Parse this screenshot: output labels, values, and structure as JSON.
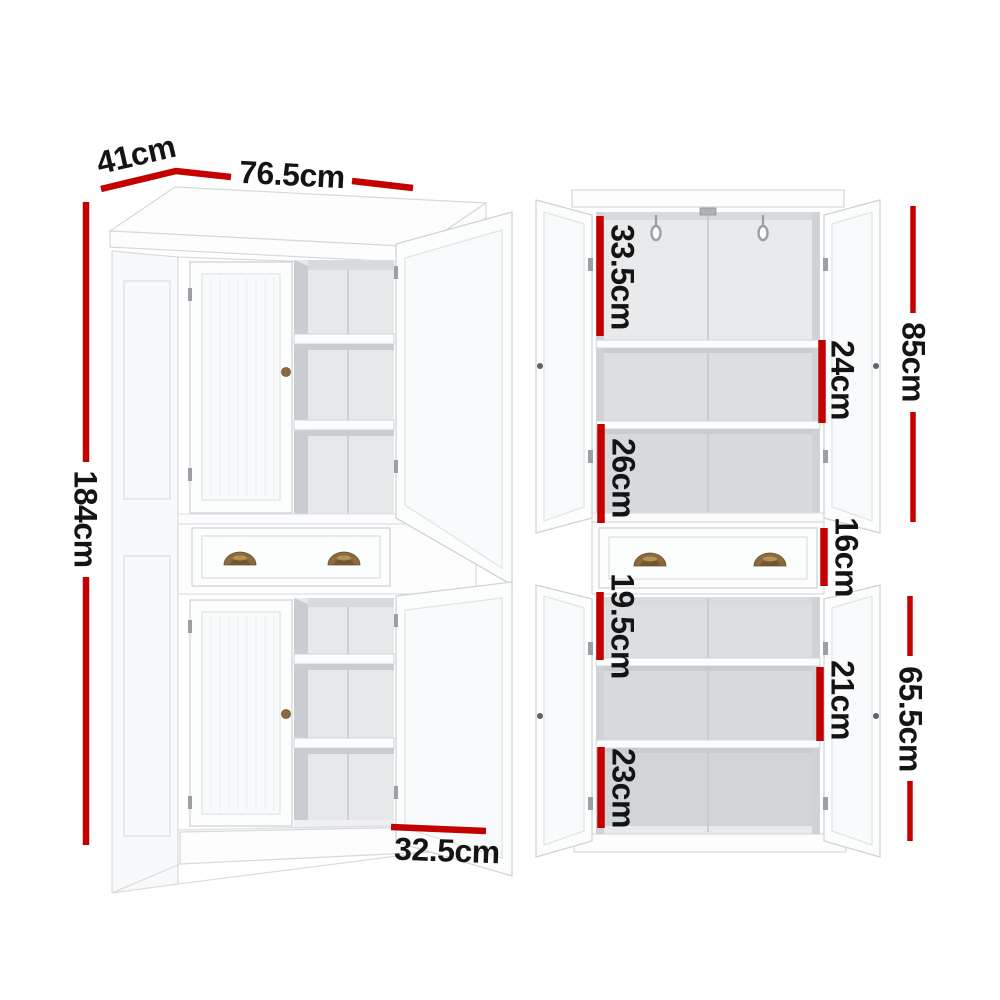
{
  "page": {
    "background": "#ffffff"
  },
  "colors": {
    "dimension_red": "#c50000",
    "label_text": "#141414",
    "handle_bronze": "#8a6a3e"
  },
  "product": {
    "name": "white-pantry-cabinet-dimension-diagram",
    "views": [
      {
        "id": "angled-view",
        "dimensions": [
          {
            "id": "depth",
            "label": "41cm"
          },
          {
            "id": "width",
            "label": "76.5cm"
          },
          {
            "id": "height",
            "label": "184cm"
          },
          {
            "id": "lower-door-width",
            "label": "32.5cm"
          }
        ]
      },
      {
        "id": "front-open-view",
        "dimensions": [
          {
            "id": "upper-top-shelf-space",
            "label": "33.5cm"
          },
          {
            "id": "upper-middle-shelf-space",
            "label": "24cm"
          },
          {
            "id": "upper-cabinet-height",
            "label": "85cm"
          },
          {
            "id": "upper-bottom-shelf-space",
            "label": "26cm"
          },
          {
            "id": "drawer-height",
            "label": "16cm"
          },
          {
            "id": "lower-top-shelf-space",
            "label": "19.5cm"
          },
          {
            "id": "lower-middle-shelf-space",
            "label": "21cm"
          },
          {
            "id": "lower-cabinet-height",
            "label": "65.5cm"
          },
          {
            "id": "lower-bottom-shelf-space",
            "label": "23cm"
          }
        ]
      }
    ]
  }
}
